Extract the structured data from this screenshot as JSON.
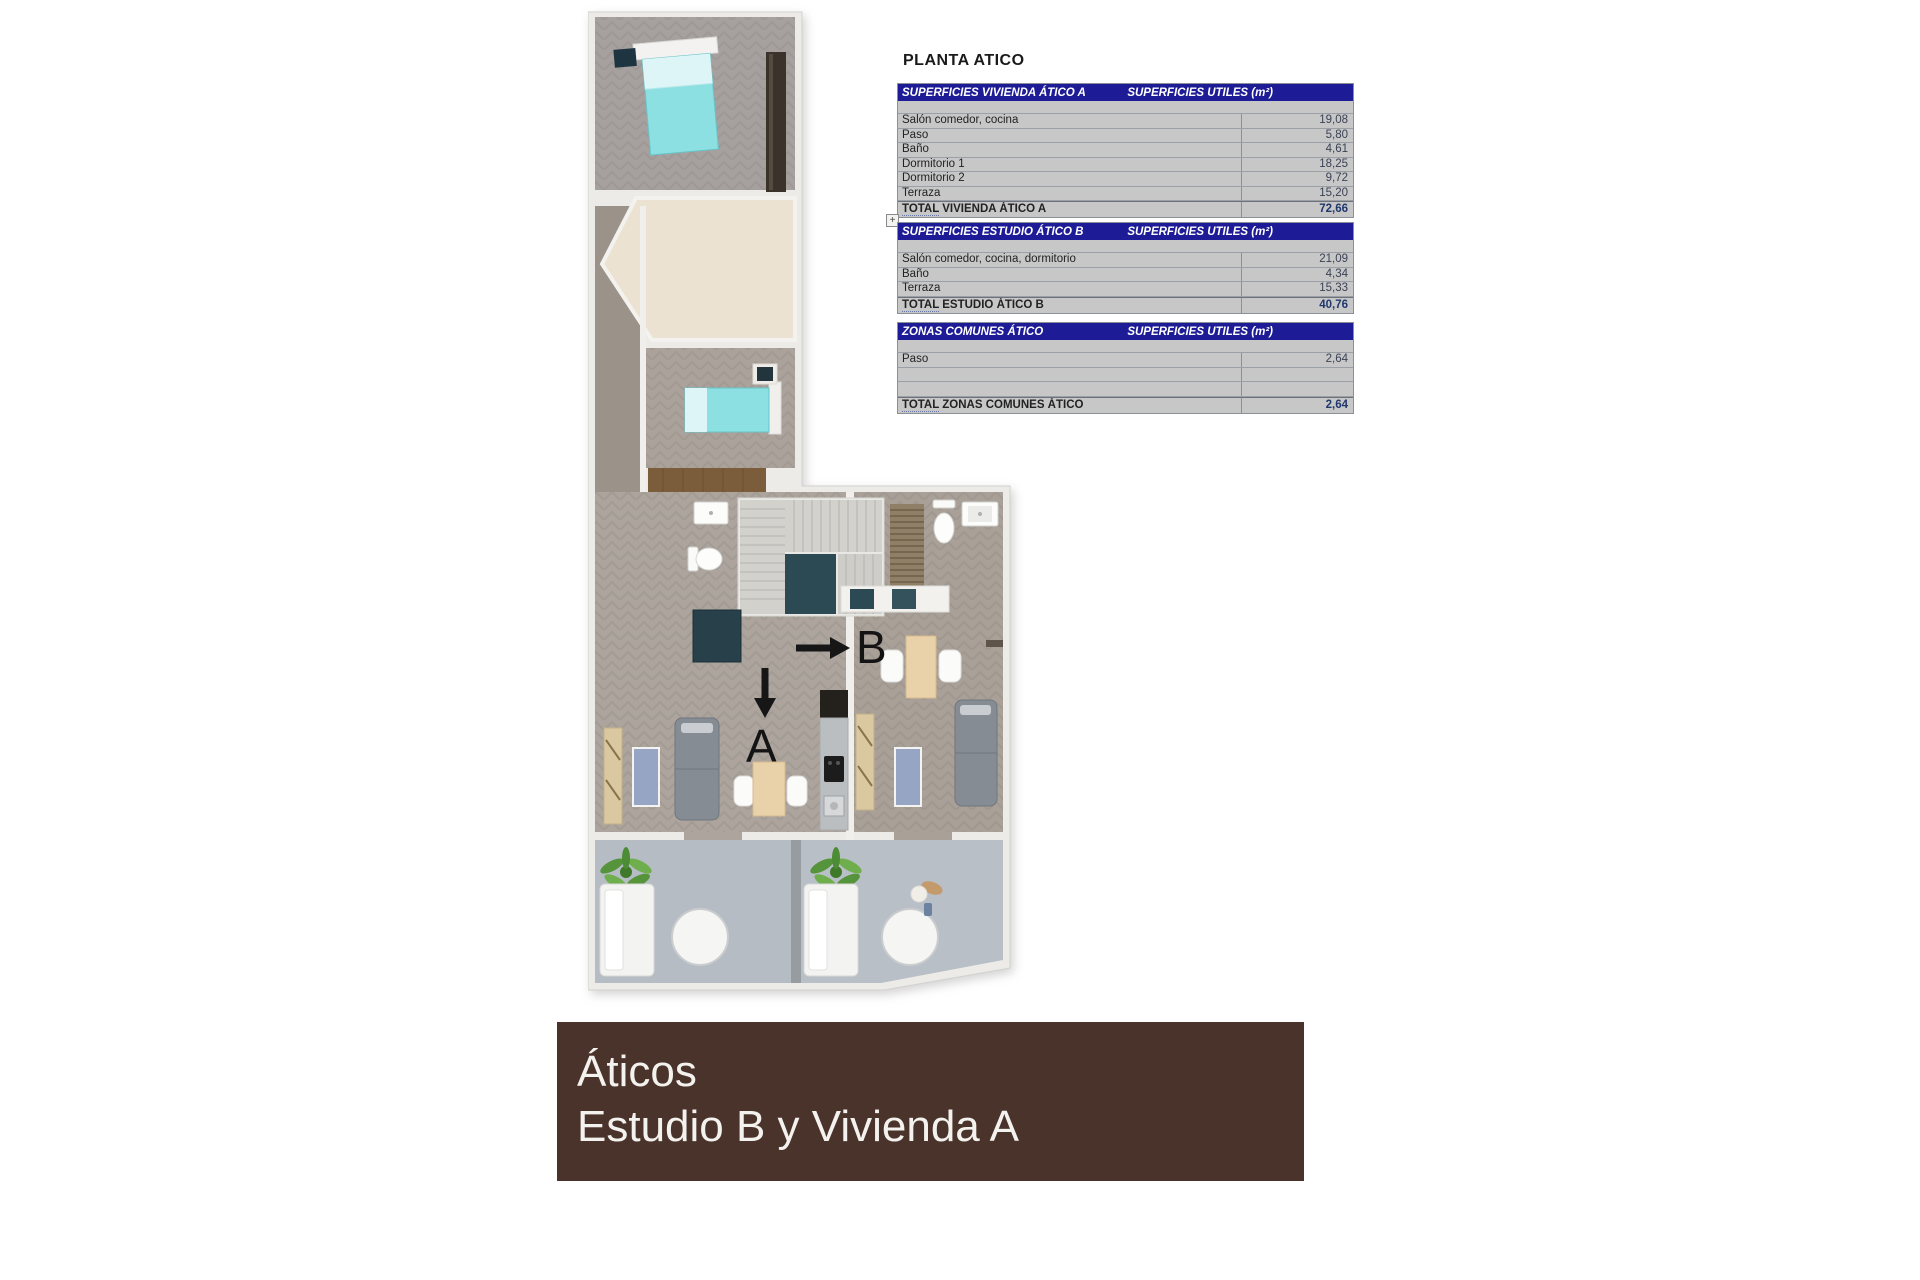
{
  "plan_title": "PLANTA ATICO",
  "outline_expand_label": "+",
  "tables": [
    {
      "name": "superficies-vivienda-atico-a",
      "header_left": "SUPERFICIES VIVIENDA ÁTICO A",
      "header_right": "SUPERFICIES UTILES  (m²)",
      "rows": [
        {
          "label": "Salón comedor, cocina",
          "value": "19,08"
        },
        {
          "label": "Paso",
          "value": "5,80"
        },
        {
          "label": "Baño",
          "value": "4,61"
        },
        {
          "label": "Dormitorio 1",
          "value": "18,25"
        },
        {
          "label": "Dormitorio 2",
          "value": "9,72"
        },
        {
          "label": "Terraza",
          "value": "15,20"
        }
      ],
      "total": {
        "prefix": "TOTAL",
        "rest": " VIVIENDA ÁTICO A",
        "value": "72,66"
      }
    },
    {
      "name": "superficies-estudio-atico-b",
      "header_left": "SUPERFICIES ESTUDIO ÁTICO B",
      "header_right": "SUPERFICIES UTILES  (m²)",
      "rows": [
        {
          "label": "Salón comedor, cocina, dormitorio",
          "value": "21,09"
        },
        {
          "label": "Baño",
          "value": "4,34"
        },
        {
          "label": "Terraza",
          "value": "15,33"
        }
      ],
      "total": {
        "prefix": "TOTAL",
        "rest": " ESTUDIO ÁTICO B",
        "value": "40,76"
      }
    },
    {
      "name": "zonas-comunes-atico",
      "header_left": "ZONAS COMUNES ÁTICO",
      "header_right": "SUPERFICIES UTILES  (m²)",
      "rows": [
        {
          "label": "Paso",
          "value": "2,64"
        },
        {
          "label": "",
          "value": ""
        },
        {
          "label": "",
          "value": ""
        }
      ],
      "total": {
        "prefix": "TOTAL",
        "rest": " ZONAS COMUNES ÁTICO",
        "value": "2,64"
      }
    }
  ],
  "plan": {
    "unit_a_label": "A",
    "unit_b_label": "B",
    "arrow_down_icon": "↓",
    "arrow_right_icon": "→"
  },
  "banner": {
    "line1": "Áticos",
    "line2": "Estudio B y Vivienda A"
  },
  "colors": {
    "table_header_navy": "#1d1b96",
    "table_cell_gray": "#c7c7c7",
    "total_value_navy": "#20386c",
    "banner_brown": "#4a332a",
    "bed_teal": "#8ce0e2",
    "terrace_gray": "#b7bdc5",
    "floor_taupe": "#aca49d",
    "stairwell_teal": "#2b4a53"
  }
}
